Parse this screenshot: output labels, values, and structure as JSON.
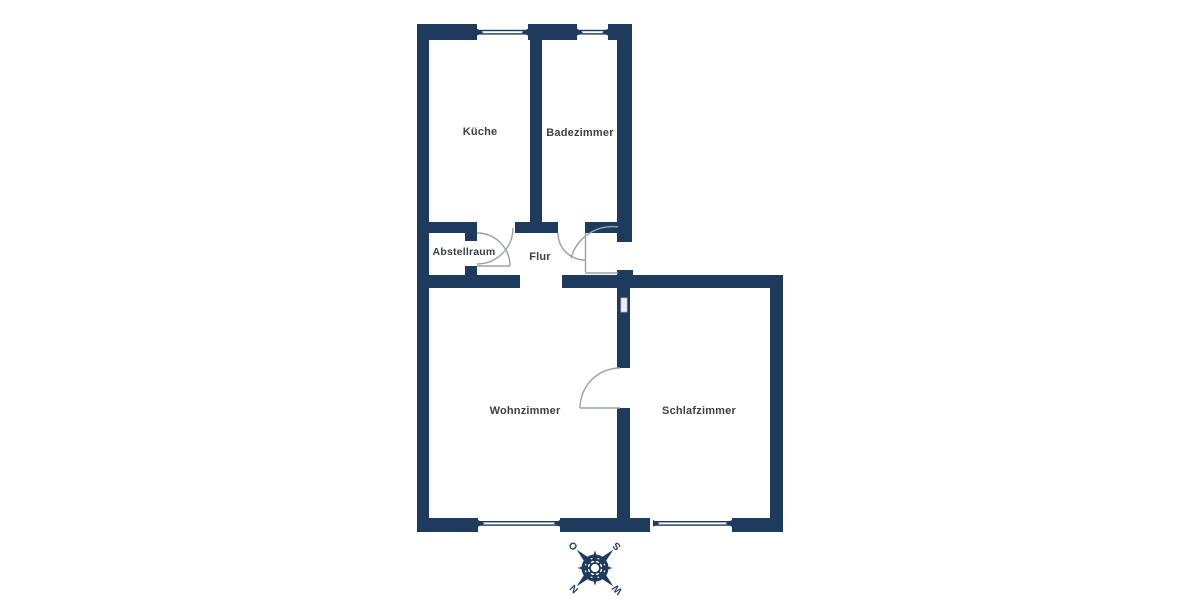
{
  "floorplan": {
    "rooms": [
      {
        "id": "kueche",
        "label": "Küche"
      },
      {
        "id": "badezimmer",
        "label": "Badezimmer"
      },
      {
        "id": "abstellraum",
        "label": "Abstellraum"
      },
      {
        "id": "flur",
        "label": "Flur"
      },
      {
        "id": "wohnzimmer",
        "label": "Wohnzimmer"
      },
      {
        "id": "schlafzimmer",
        "label": "Schlafzimmer"
      }
    ],
    "compass": {
      "north": "N",
      "east": "O",
      "south": "S",
      "west": "W"
    },
    "colors": {
      "wall": "#1e3a5c",
      "label_text": "#3a4047",
      "door_stroke": "#9aa0a6",
      "background": "#ffffff"
    }
  }
}
